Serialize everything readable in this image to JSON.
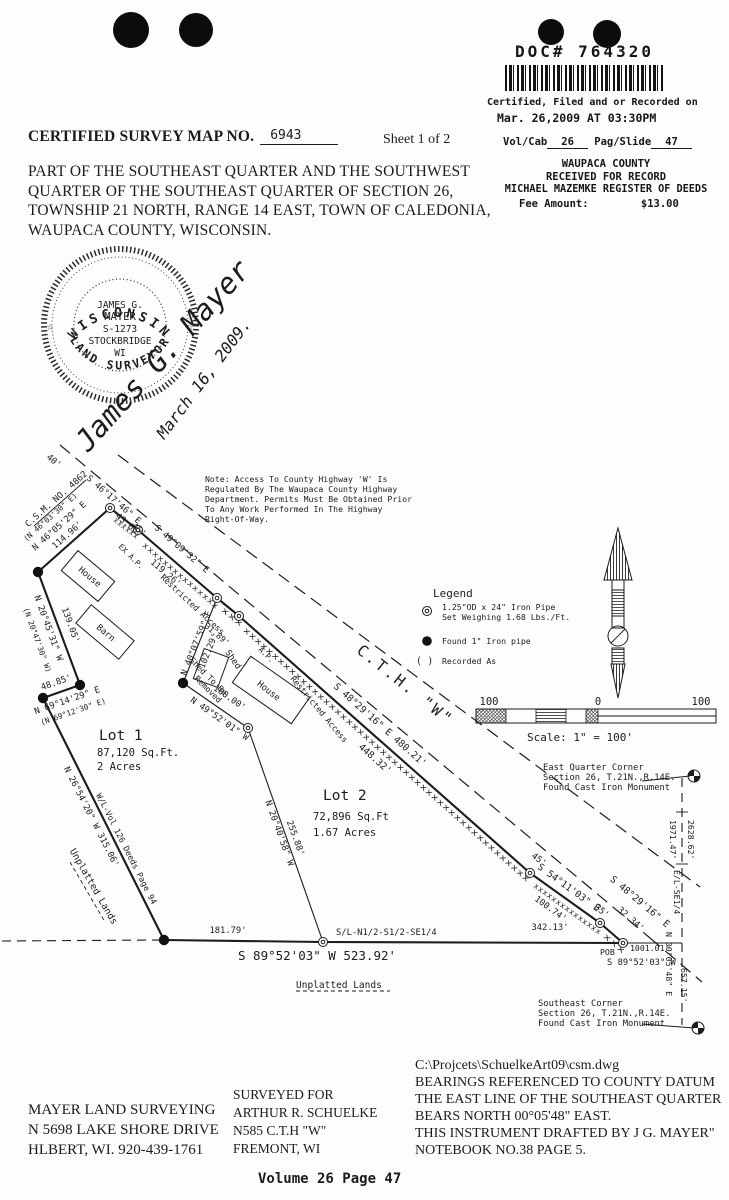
{
  "stamp": {
    "doc_number": "DOC# 764320",
    "certified_line1": "Certified, Filed and or Recorded on",
    "certified_line2": "Mar. 26,2009 AT 03:30PM",
    "vol_label": "Vol/Cab",
    "vol_value": "26",
    "page_label": "Pag/Slide",
    "page_value": "47",
    "county": "WAUPACA COUNTY",
    "received": "RECEIVED FOR RECORD",
    "register": "MICHAEL MAZEMKE REGISTER OF DEEDS",
    "fee_label": "Fee Amount:",
    "fee_value": "$13.00"
  },
  "title": {
    "label": "CERTIFIED SURVEY MAP NO.",
    "number": "6943",
    "sheet": "Sheet 1 of 2"
  },
  "description": {
    "line1": "PART OF THE SOUTHEAST QUARTER AND THE SOUTHWEST",
    "line2": "QUARTER OF THE SOUTHEAST QUARTER OF SECTION 26,",
    "line3": "TOWNSHIP 21 NORTH, RANGE 14 EAST, TOWN OF CALEDONIA,",
    "line4": "WAUPACA COUNTY, WISCONSIN."
  },
  "seal": {
    "top_arc": "WISCONSIN",
    "bottom_arc": "LAND SURVEYOR",
    "line1": "JAMES G.",
    "line2": "MAYER",
    "line3": "S-1273",
    "line4": "STOCKBRIDGE",
    "line5": "WI",
    "star": "☆",
    "signature": "James G. Mayer",
    "date": "March 16, 2009."
  },
  "note": {
    "lines": [
      "Note: Access To County Highway 'W' Is",
      "Regulated By The Waupaca County Highway",
      "Department. Permits Must Be Obtained Prior",
      "To Any Work Performed In The Highway",
      "Right-Of-Way."
    ]
  },
  "legend": {
    "title": "Legend",
    "item1_line1": "1.25\"OD x 24\" Iron Pipe",
    "item1_line2": "Set Weighing 1.68 Lbs./Ft.",
    "item2": "Found 1\" Iron pipe",
    "paren": "( )",
    "item3": "Recorded As"
  },
  "scale": {
    "left": "100",
    "zero": "0",
    "right": "100",
    "caption": "Scale: 1\" = 100'"
  },
  "corners": {
    "east_quarter": [
      "East Quarter Corner",
      "Section 26, T.21N.,R.14E.",
      "Found Cast Iron Monument"
    ],
    "southeast": [
      "Southeast Corner",
      "Section 26, T.21N.,R.14E.",
      "Found Cast Iron Monument"
    ]
  },
  "lots": {
    "lot1_name": "Lot 1",
    "lot1_area": "87,120 Sq.Ft.",
    "lot1_acres": "2 Acres",
    "lot2_name": "Lot 2",
    "lot2_area": "72,896 Sq.Ft",
    "lot2_acres": "1.67 Acres"
  },
  "map": {
    "labels": {
      "w40": "40'",
      "bearing_4617": "S 46°17'46\" E",
      "d_4365": "43.65'",
      "w45_top": "45'",
      "csm4862": "C.S.M. NO. 4862",
      "rec_4603": "(N 46°03'30\" E)",
      "bearing_4605": "N 46°05'29\" E",
      "d_11496": "114.96'",
      "bearing_4909": "S 49°09'32\" E",
      "d_11926": "119.26'",
      "d_3189": "31.89'",
      "ex_ap": "EX A.P.",
      "ap": "A.P.",
      "restricted1": "Restricted Access",
      "restricted2": "Restricted Access",
      "bearing_4829_main": "S 48°29'16\" E 480.21'",
      "d_44832": "448.32'",
      "cth": "C.T.H. \"W\"",
      "w45_low": "45'",
      "w35": "35'",
      "bearing_5411": "S 54°11'03\" E",
      "d_10074": "100.74'",
      "d_3234": "32.34'",
      "bearing_4829_cl": "S 48°29'16\" E",
      "bearing_2045": "N 20°45'31\" W",
      "rec_2047": "(N 20°47'30\" W)",
      "d_13905": "139.05'",
      "d_4885": "48.85'",
      "bearing_6914": "N 69°14'29\" E",
      "rec_6912": "(N 69°12'30\" E)",
      "bearing_2654": "N 26°54'20\" W 315.06'",
      "wl_deeds": "W/L-Vol 126 Deeds Page 94",
      "unplatted_left": "Unplatted Lands",
      "unplatted_bottom": "Unplatted Lands",
      "bearing_4007": "N 40°07'59\" E",
      "d_10229": "102.29'",
      "d_10000": "100.00'",
      "bearing_4952": "N 49°52'01\" W",
      "d_25588": "255.88'",
      "bearing_2040": "N 20°40'58\" W",
      "d_18179": "181.79'",
      "sl_label": "S/L-N1/2-S1/2-SE1/4",
      "d_34213": "342.13'",
      "bearing_8952_main": "S 89°52'03\" W 523.92'",
      "pob": "POB",
      "d_100101": "1001.01'",
      "bearing_8952_pob": "S 89°52'03\" W",
      "d_197147": "1971.47'",
      "d_262862": "2628.62'",
      "el_se": "E/L-SE1/4",
      "bearing_0005": "N 00°05'48\" E",
      "d_65715": "657.15'",
      "house1": "House",
      "barn": "Barn",
      "shed": "Shed",
      "shed_rm1": "Shed To Be",
      "shed_rm2": "Removed",
      "house2": "House"
    },
    "hatch": {
      "tiny": "xxx",
      "small": "xxxxxx",
      "med": "xxxxxxxxxxxxxxx",
      "long": "xxxxxxxxxxxxxxxxxxxxxxxxxxxxxxxxxxxxxxxxxxxxxxxxxx"
    }
  },
  "footer": {
    "surveyor": [
      "MAYER LAND SURVEYING",
      "N 5698 LAKE SHORE DRIVE",
      "HLBERT, WI. 920-439-1761"
    ],
    "surveyed_for": [
      "SURVEYED FOR",
      "ARTHUR R. SCHUELKE",
      "N585 C.T.H \"W\"",
      "FREMONT, WI"
    ],
    "notes": [
      "C:\\Projcets\\SchuelkeArt09\\csm.dwg",
      "BEARINGS REFERENCED TO COUNTY DATUM",
      "THE EAST LINE OF THE SOUTHEAST QUARTER",
      "BEARS NORTH 00°05'48\" EAST.",
      "THIS INSTRUMENT DRAFTED BY J G. MAYER\"",
      "NOTEBOOK NO.38 PAGE 5."
    ],
    "volume_page": "Volume 26 Page 47"
  }
}
